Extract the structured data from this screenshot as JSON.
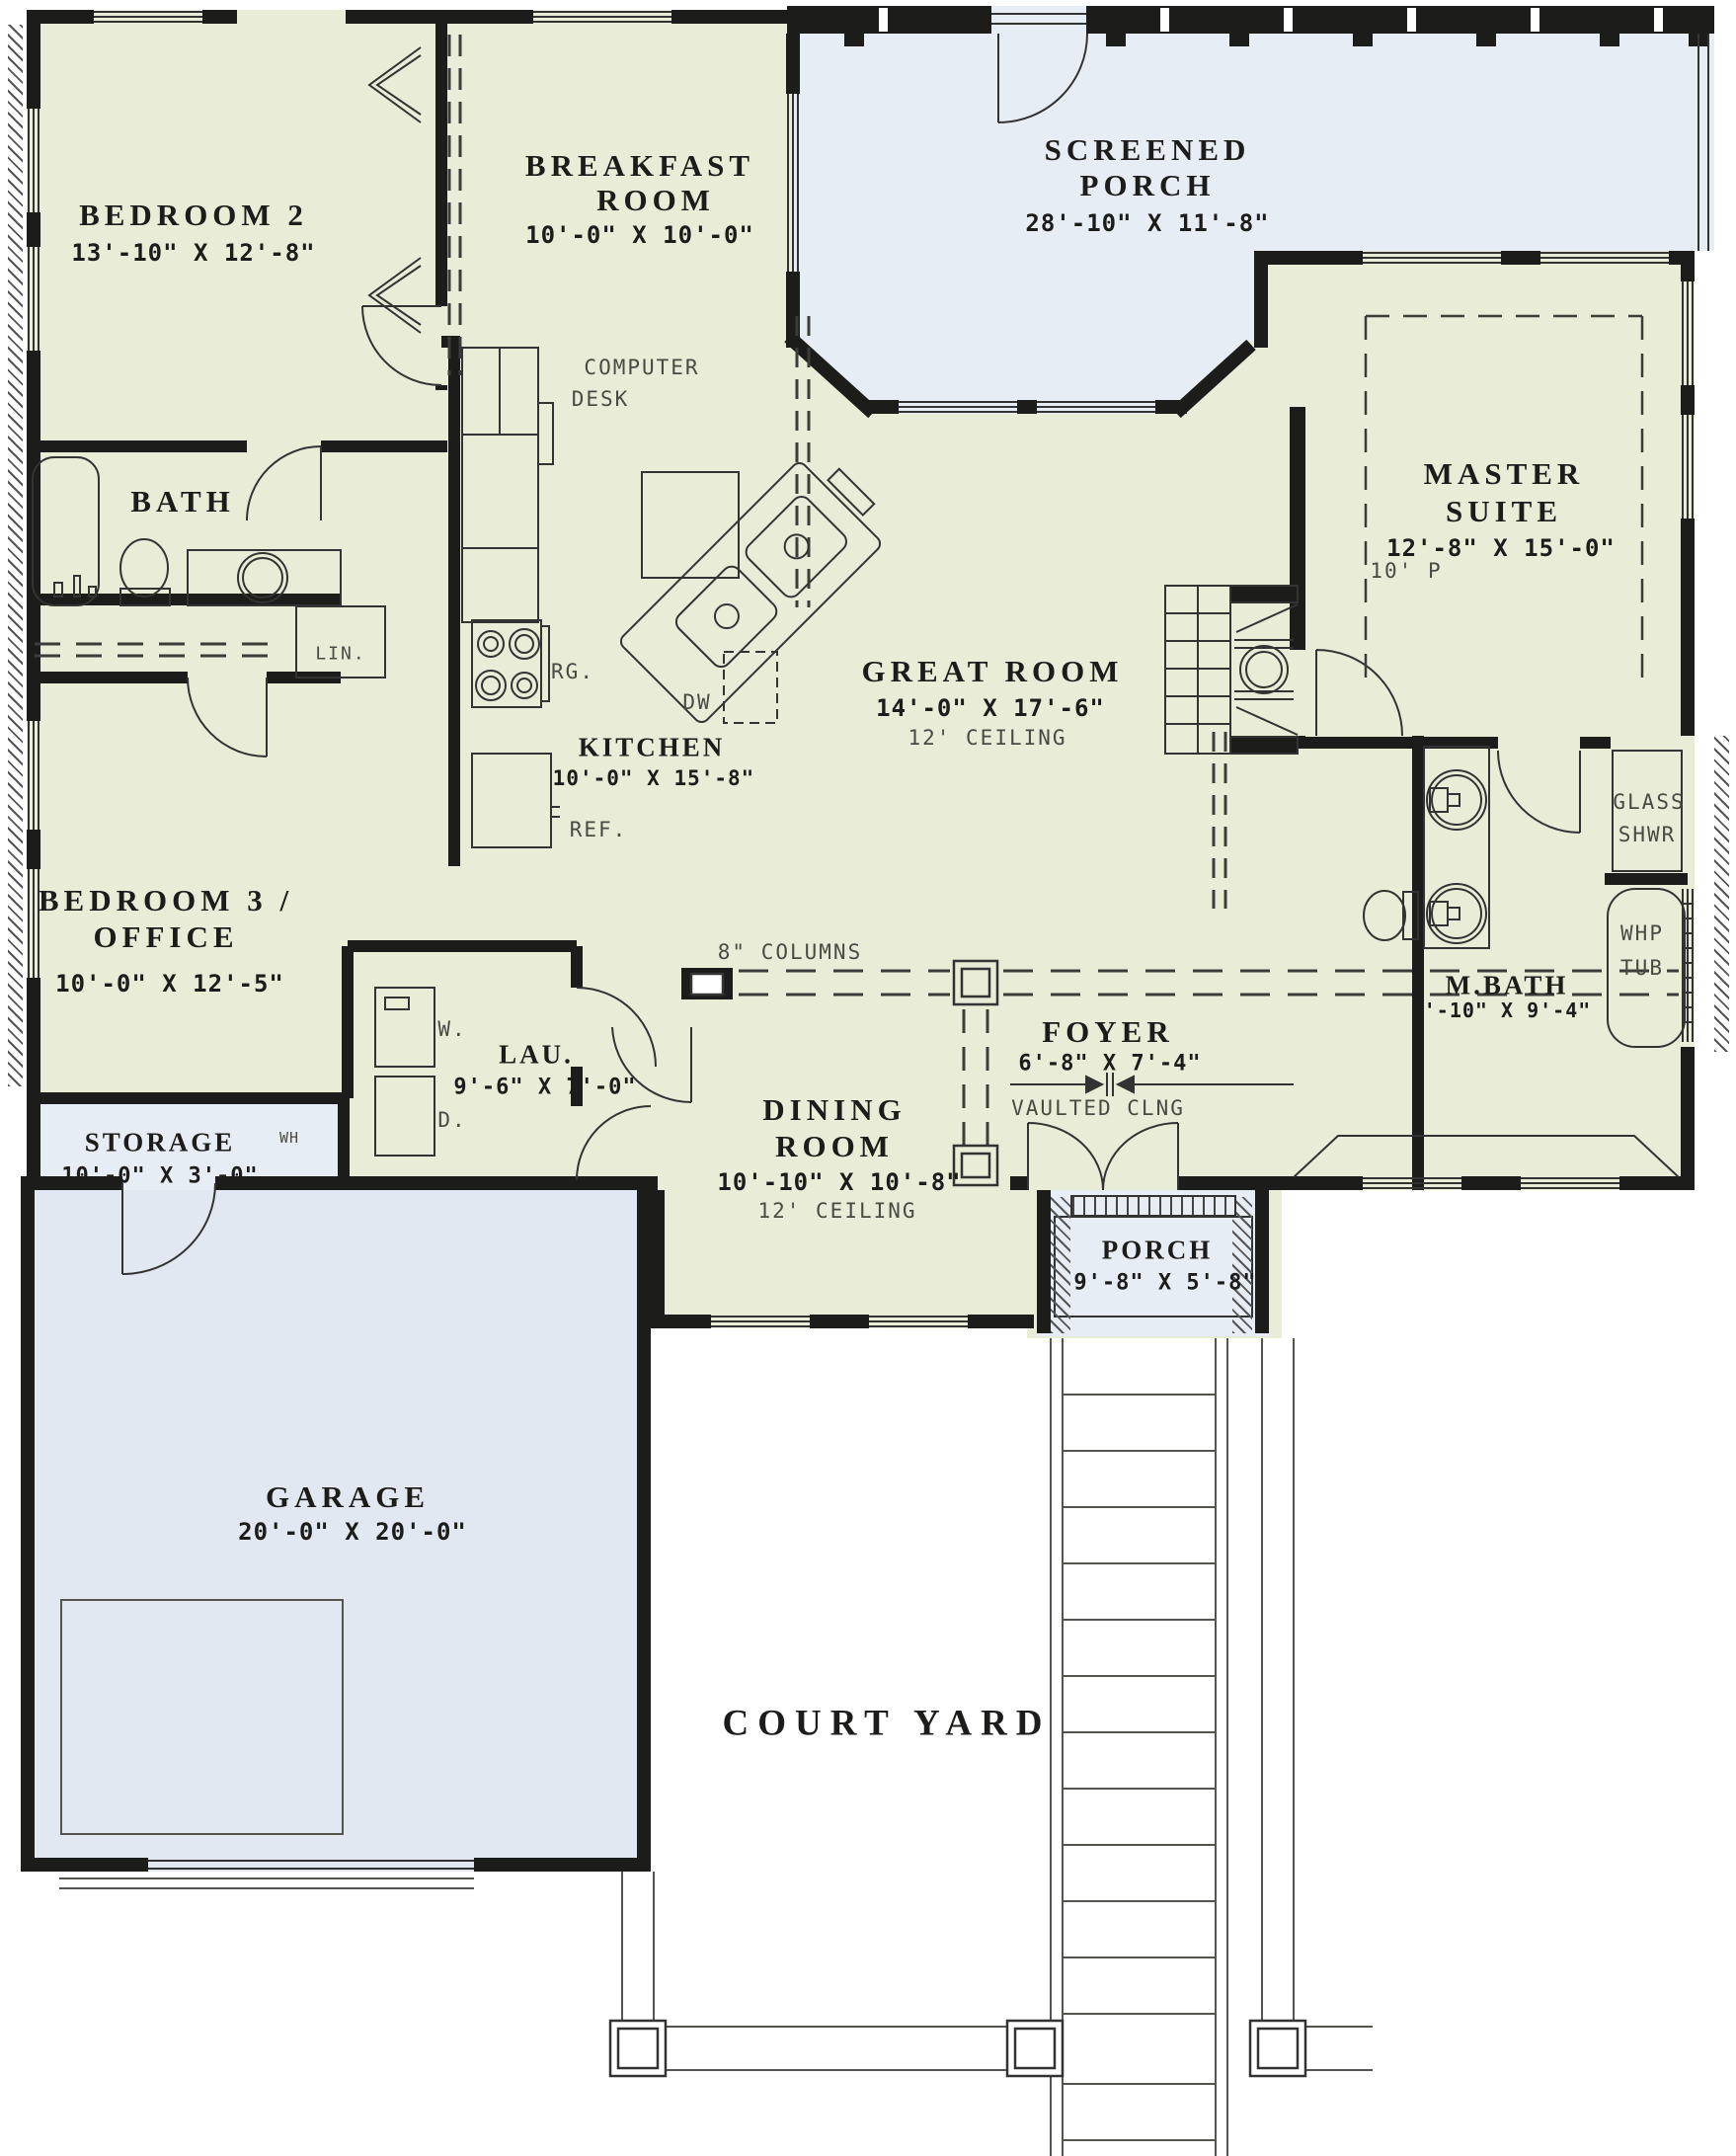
{
  "colors": {
    "interior": "#e9ecd6",
    "outdoor": "#e7edf5",
    "wall": "#1c1c1a",
    "thin_line": "#3c3c38",
    "muted_text": "#4a4a44"
  },
  "labels": {
    "bedroom2": {
      "name": "BEDROOM 2",
      "dims": "13'-10\" X 12'-8\""
    },
    "breakfast": {
      "name1": "BREAKFAST",
      "name2": "ROOM",
      "dims": "10'-0\" X 10'-0\""
    },
    "screened_porch": {
      "name1": "SCREENED",
      "name2": "PORCH",
      "dims": "28'-10\" X 11'-8\""
    },
    "master": {
      "name1": "MASTER",
      "name2": "SUITE",
      "dims": "12'-8\" X 15'-0\"",
      "plate": "10' P"
    },
    "great_room": {
      "name": "GREAT ROOM",
      "dims": "14'-0\" X 17'-6\"",
      "ceiling": "12' CEILING"
    },
    "kitchen": {
      "name": "KITCHEN",
      "dims": "10'-0\" X 15'-8\""
    },
    "bath": {
      "name": "BATH"
    },
    "bedroom3": {
      "name1": "BEDROOM 3 /",
      "name2": "OFFICE",
      "dims": "10'-0\" X 12'-5\""
    },
    "storage": {
      "name": "STORAGE",
      "dims": "10'-0\" X 3'-0\""
    },
    "laundry": {
      "name": "LAU.",
      "dims": "9'-6\" X 7'-0\"",
      "washer": "W.",
      "dryer": "D."
    },
    "dining": {
      "name1": "DINING",
      "name2": "ROOM",
      "dims": "10'-10\" X 10'-8\"",
      "ceiling": "12' CEILING"
    },
    "foyer": {
      "name": "FOYER",
      "dims": "6'-8\" X 7'-4\"",
      "ceiling": "VAULTED CLNG"
    },
    "master_bath": {
      "name": "M.BATH",
      "dims": "8'-10\" X 9'-4\""
    },
    "glass_shower": {
      "name1": "GLASS",
      "name2": "SHWR"
    },
    "whirlpool_tub": {
      "name1": "WHP",
      "name2": "TUB"
    },
    "entry_porch": {
      "name": "PORCH",
      "dims": "9'-8\" X 5'-8\""
    },
    "garage": {
      "name": "GARAGE",
      "dims": "20'-0\" X 20'-0\""
    },
    "court_yard": {
      "name": "COURT YARD"
    },
    "annotations": {
      "computer_desk1": "COMPUTER",
      "computer_desk2": "DESK",
      "range": "RG.",
      "dishwasher": "DW",
      "refrigerator": "REF.",
      "linen": "LIN.",
      "water_heater": "WH",
      "columns": "8\" COLUMNS"
    }
  }
}
